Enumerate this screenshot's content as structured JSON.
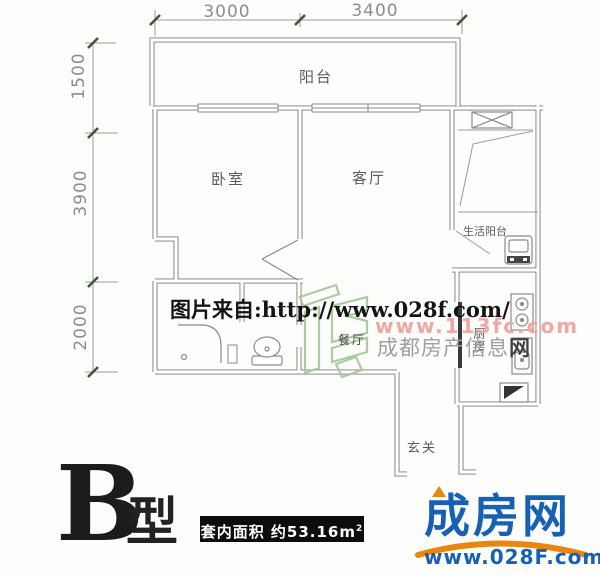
{
  "plan": {
    "dims_top": [
      "3000",
      "3400"
    ],
    "dims_left": [
      "1500",
      "3900",
      "2000"
    ],
    "rooms": {
      "balcony": "阳台",
      "bedroom": "卧室",
      "living": "客厅",
      "dining": "餐厅",
      "kitchen": "厨房",
      "service_balcony": "生活阳台",
      "entry": "玄关"
    }
  },
  "watermarks": {
    "source": "图片来自:http://www.028f.com/",
    "pink_url": "www.113fc.com",
    "gray_name": "成都房产信息",
    "gray_suffix": "网"
  },
  "footer": {
    "type_letter": "B",
    "type_word": "型",
    "area_text": "套内面积 约53.16m",
    "area_sup": "2"
  },
  "logo": {
    "name": "成房网",
    "url": "www.028F.com"
  },
  "colors": {
    "wall": "#7a7a7a",
    "dim_line": "#9a9a9a",
    "tick_green": "#3c5a34",
    "logo_blue": "#1660b6",
    "logo_orange": "#e8860f",
    "watermark_pink": "#efa8a2",
    "watermark_green": "#a2c795",
    "watermark_gray": "#9f9f9f"
  }
}
